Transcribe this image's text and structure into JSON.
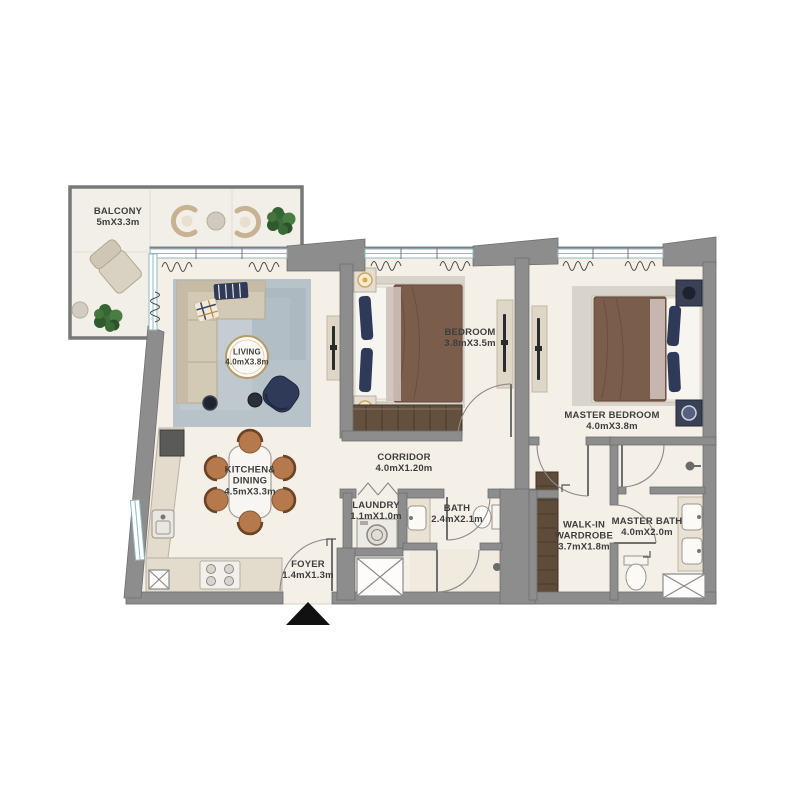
{
  "floorplan": {
    "type": "apartment-2-bedroom",
    "entry_marker": "black-triangle",
    "colors": {
      "wall": "#8d8d8d",
      "wall_edge": "#6f6f6f",
      "floor": "#f4efe7",
      "balcony_floor": "#f2efe9",
      "window_glass": "#9fc3cc",
      "label_text": "#3e3e3e",
      "wardrobe_wood": "#5e4b3a",
      "navy_accent": "#2e3a58",
      "rug_blue": "#b8c2c9",
      "sofa_beige": "#d3cab6",
      "bed_blanket": "#7b5d4b",
      "dining_chair": "#b5794c",
      "plant_green": "#3c6b38",
      "entry_marker": "#111111"
    }
  },
  "rooms": {
    "balcony": {
      "name": "BALCONY",
      "dims": "5mX3.3m"
    },
    "living": {
      "name": "LIVING",
      "dims": "4.0mX3.8m"
    },
    "bedroom": {
      "name": "BEDROOM",
      "dims": "3.8mX3.5m"
    },
    "master_bedroom": {
      "name": "MASTER BEDROOM",
      "dims": "4.0mX3.8m"
    },
    "corridor": {
      "name": "CORRIDOR",
      "dims": "4.0mX1.20m"
    },
    "kitchen_dining": {
      "line1": "KITCHEN&",
      "line2": "DINING",
      "dims": "4.5mX3.3m"
    },
    "laundry": {
      "name": "LAUNDRY",
      "dims": "1.1mX1.0m"
    },
    "bath": {
      "name": "BATH",
      "dims": "2.4mX2.1m"
    },
    "foyer": {
      "name": "FOYER",
      "dims": "1.4mX1.3m"
    },
    "walk_in_wardrobe": {
      "line1": "WALK-IN",
      "line2": "WARDROBE",
      "dims": "3.7mX1.8m"
    },
    "master_bath": {
      "name": "MASTER BATH",
      "dims": "4.0mX2.0m"
    }
  }
}
